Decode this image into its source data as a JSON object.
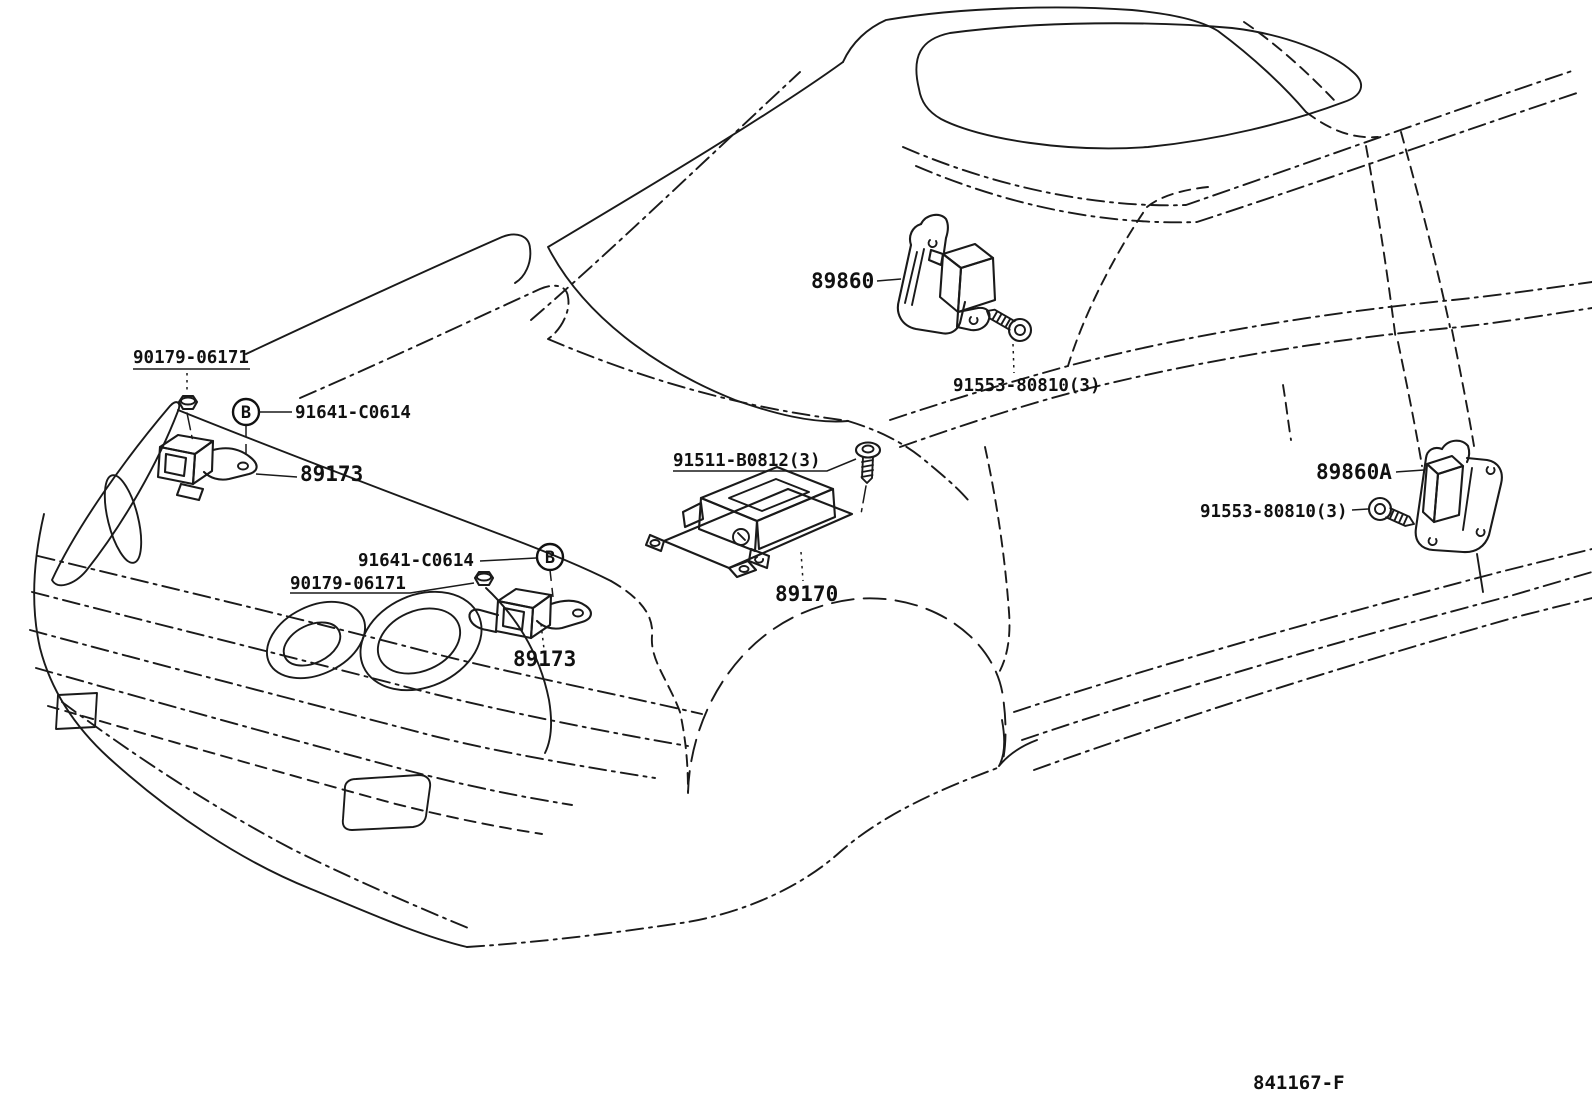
{
  "diagram": {
    "drawing_number": "841167-F",
    "bolt_symbol_letter": "B",
    "callouts": [
      {
        "id": "nut-front-upper",
        "part_number": "90179-06171"
      },
      {
        "id": "bolt-b-front-upper",
        "part_number": "91641-C0614"
      },
      {
        "id": "front-sensor-upper",
        "part_number": "89173"
      },
      {
        "id": "center-sensor-screw",
        "part_number": "91511-B0812(3)"
      },
      {
        "id": "side-sensor-front",
        "part_number": "89860"
      },
      {
        "id": "side-screw-front",
        "part_number": "91553-80810(3)"
      },
      {
        "id": "bolt-b-front-lower",
        "part_number": "91641-C0614"
      },
      {
        "id": "nut-front-lower",
        "part_number": "90179-06171"
      },
      {
        "id": "center-sensor-assembly",
        "part_number": "89170"
      },
      {
        "id": "front-sensor-lower",
        "part_number": "89173"
      },
      {
        "id": "side-sensor-rear",
        "part_number": "89860A"
      },
      {
        "id": "side-screw-rear",
        "part_number": "91553-80810(3)"
      }
    ]
  }
}
